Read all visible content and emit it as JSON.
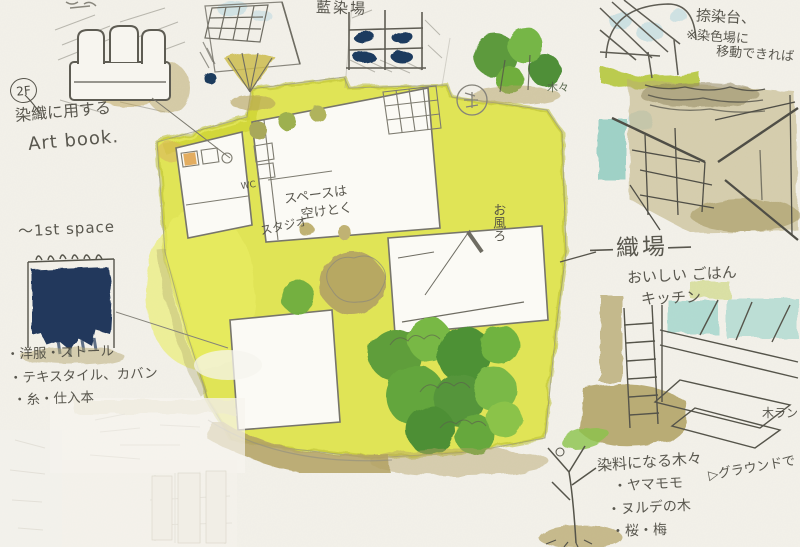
{
  "palette": {
    "paper": "#f3f1ea",
    "site_yellow": "#dee34a",
    "olive_tan": "#b3a264",
    "tree_green": "#6fae3e",
    "indigo_navy": "#1d3a5e",
    "teal_wash": "#86c7bd",
    "pencil_gray": "#6e6c64"
  },
  "sketch": {
    "artbook": {
      "badge": "2F",
      "line1": "染織に用する",
      "line2": "Art book."
    },
    "indigo": {
      "title": "藍染場"
    },
    "nassen": {
      "line1": "捺染台、",
      "line2": "※染色場に",
      "line3": "移動できれば"
    },
    "trees_note": "木々",
    "plan": {
      "wc": "WC",
      "space1": "スペースは",
      "space2": "空けとく",
      "studio": "スタジオ",
      "bath": "お風ろ"
    },
    "weaving": {
      "title": "―織場―",
      "line1": "おいしい ごはん",
      "line2": "キッチン"
    },
    "shop": {
      "title": "〜1st space",
      "item1": "・洋服・ストール",
      "item2": "・テキスタイル、カバン",
      "item3": "・糸・仕入本"
    },
    "dye_trees": {
      "title": "染料になる木々",
      "item1": "・ヤマモモ",
      "item2": "・ヌルデの木",
      "item3": "・桜・梅",
      "note": "▷グラウンドで"
    },
    "wood_note": "木ラン"
  }
}
